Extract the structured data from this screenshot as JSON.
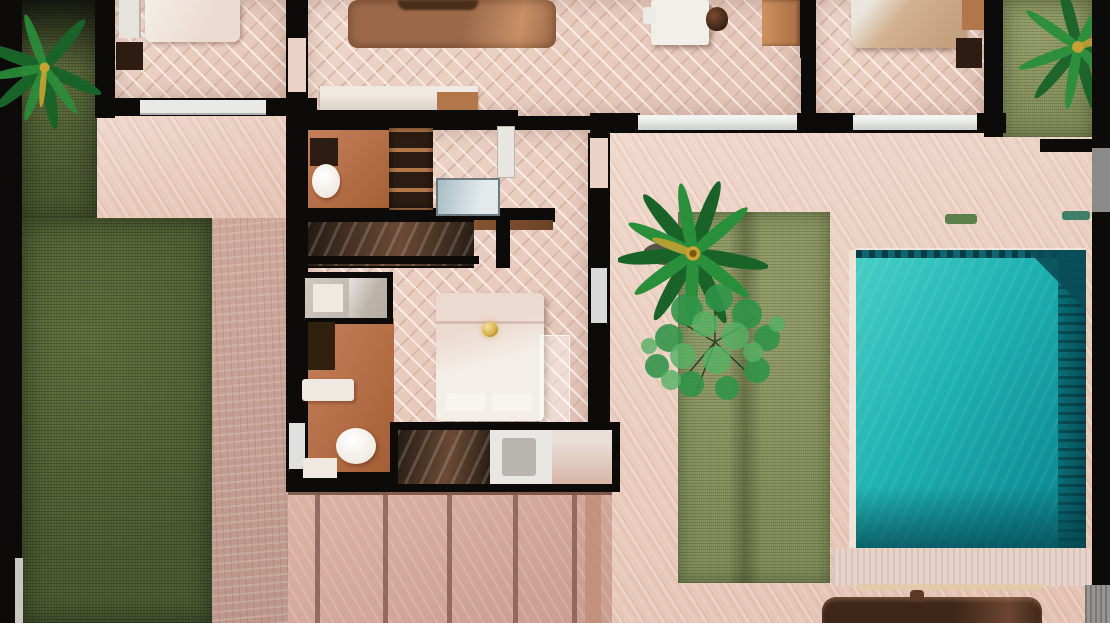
{
  "meta": {
    "kind": "photorealistic top-down 3D floor plan render of a villa",
    "view": "top-down",
    "visible_text": "none"
  },
  "scene": {
    "areas": [
      {
        "name": "left-lawn",
        "surface": "dark grass with palm tree top-left"
      },
      {
        "name": "bedroom-top-left",
        "furniture": [
          "bed",
          "wardrobe",
          "dark dresser"
        ]
      },
      {
        "name": "living-room",
        "furniture": [
          "copper rug",
          "sofa edge",
          "media console"
        ]
      },
      {
        "name": "dining-office",
        "furniture": [
          "white table",
          "white chair",
          "dark chair",
          "wood sideboard"
        ]
      },
      {
        "name": "bedroom-top-right",
        "furniture": [
          "tan bed",
          "dark bench",
          "wood nightstand"
        ]
      },
      {
        "name": "right-garden-strip",
        "surface": "sage grass with palm"
      },
      {
        "name": "master-suite",
        "furniture": [
          "glass wardrobe",
          "blue glass panel",
          "white bed with gold chandelier",
          "bathroom fixtures",
          "glass shower band"
        ]
      },
      {
        "name": "courtyard",
        "surface": "sage grass with palm tree and leafy tree"
      },
      {
        "name": "pool-terrace",
        "features": [
          "turquoise pool",
          "dark tiled ledge",
          "corner bench",
          "green accents"
        ]
      },
      {
        "name": "bottom-deck",
        "surface": "wide pink planks with seams"
      },
      {
        "name": "outdoor-lounge",
        "feature": "dark brown furniture piece at bottom edge"
      }
    ]
  },
  "colors": {
    "wall": "#0d0b09",
    "floorBase": "#eed6ca",
    "floorBase2": "#e2c2b4",
    "floorHi": "#f8ece4",
    "floorLo": "#d8b8aa",
    "terrace": "#e4c1b1",
    "terraceHi": "#f0d8cb",
    "deckStrip": "#cda89b",
    "deckStripB": "#bd968a",
    "deckPlank": "#dcb4a6",
    "deckPlankB": "#c89c8e",
    "plankSeam": "#7d564a",
    "grassDark": "#49582f",
    "grassDarkHi": "#5e6c3a",
    "grassSage": "#7d8a55",
    "grassSageHi": "#939c66",
    "palmGreen": "#2a8f3a",
    "palmGreenDark": "#196329",
    "palmYellow": "#c9a232",
    "treeGreen": "#2f9448",
    "treeGreenLight": "#55b264",
    "branchDark": "#1c3a22",
    "poolA": "#48cfc6",
    "poolB": "#1fb2b3",
    "poolC": "#0f9098",
    "poolD": "#0b838d",
    "poolLedge": "#0a6f78",
    "poolLedgeDark": "#064e57",
    "poolBench": "#0a4d58",
    "poolTile": "#0e6570",
    "copingLight": "#f2e1d7",
    "pavingLight": "#e7d3ca",
    "terracotta": "#c4805d",
    "terracottaDark": "#a55e33",
    "rugA": "#9c6848",
    "rugB": "#c79066",
    "sofaDark": "#4a2e1c",
    "woodFurniture": "#b1774a",
    "woodLight": "#cd9260",
    "tableWhite": "#f2efe9",
    "chairDark": "#3a2315",
    "bedTan": "#d2b291",
    "bedPillow": "#eae5dd",
    "bedWhiteA": "#ecd9cf",
    "bedWhiteB": "#f3efe8",
    "glassBlueA": "#a9bcc4",
    "glassBlueB": "#e2eaec",
    "glassDarkA": "#241a12",
    "glassDarkB": "#6b4a35",
    "glassPink": "#d8b6a8",
    "fixtureWhite": "#efe9e1",
    "darkFurniture": "#2c1c11",
    "windowSillGray": "#ccd0cf",
    "windowWhite": "#e9eae8",
    "grayStrip": "#8b8b89",
    "grayStripB": "#989692",
    "gold": "#d8b24e",
    "loungeBrown": "#3f2618",
    "loungeBrownHi": "#6b4530",
    "doorGap": "#ead2c7",
    "accentGreen1": "#5d7f4b",
    "accentGreen2": "#3f8168"
  }
}
